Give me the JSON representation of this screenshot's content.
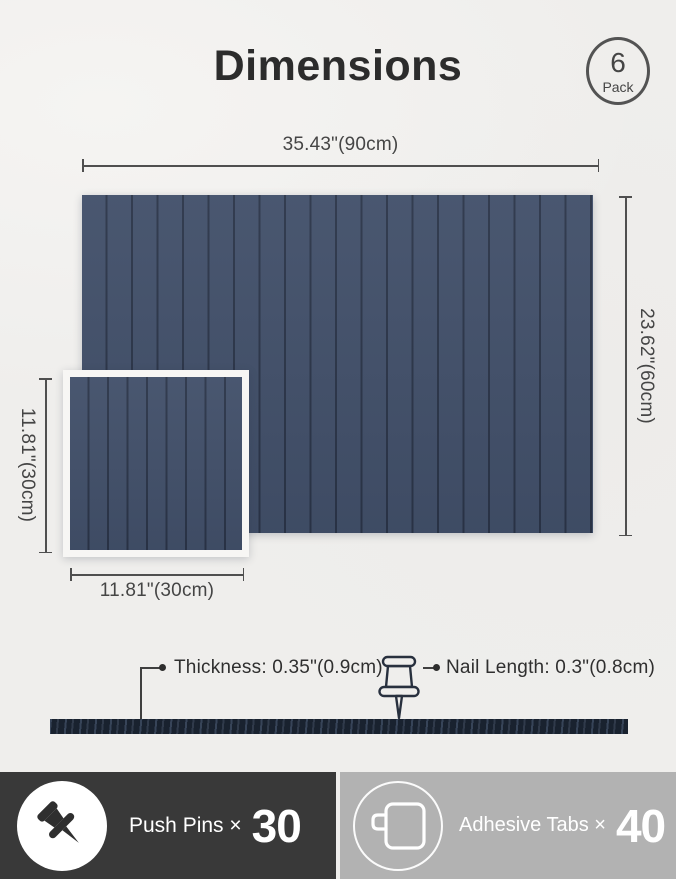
{
  "header": {
    "title": "Dimensions",
    "badge": {
      "count": "6",
      "unit": "Pack"
    }
  },
  "dims": {
    "top": "35.43\"(90cm)",
    "right": "23.62\"(60cm)",
    "left_small": "11.81\"(30cm)",
    "bottom_small": "11.81\"(30cm)"
  },
  "side": {
    "thickness": "Thickness: 0.35\"(0.9cm)",
    "nail": "Nail Length: 0.3\"(0.8cm)"
  },
  "footer": {
    "left": {
      "label": "Push Pins ×",
      "count": "30"
    },
    "right": {
      "label": "Adhesive Tabs ×",
      "count": "40"
    }
  },
  "colors": {
    "background": "#efeeec",
    "panel": "#42506a",
    "panel_groove": "#2b3549",
    "side_bar": "#19222f",
    "footer_left_bg": "#393939",
    "footer_right_bg": "#b2b2b2",
    "dimension_line": "#4f4f4f"
  },
  "icons": [
    "pack-count-badge",
    "push-pin-outline-icon",
    "push-pin-icon",
    "adhesive-tab-icon"
  ]
}
